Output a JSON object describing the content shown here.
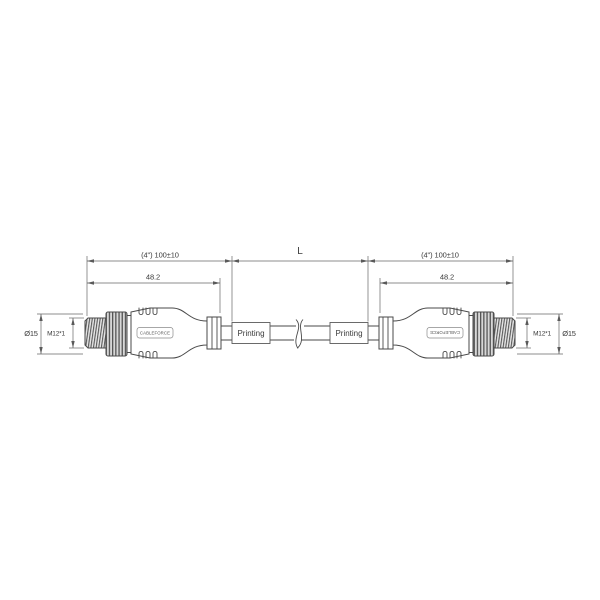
{
  "dimensions": {
    "overall_left": "(4\") 100±10",
    "overall_right": "(4\") 100±10",
    "length_label": "L",
    "body_left": "48.2",
    "body_right": "48.2",
    "thread_left": "M12*1",
    "thread_right": "M12*1",
    "diameter_left": "Ø15",
    "diameter_right": "Ø15"
  },
  "labels": {
    "printing_left": "Printing",
    "printing_right": "Printing",
    "brand_left": "CABLEFORCE",
    "brand_right": "CABLEFORCE"
  },
  "colors": {
    "outline": "#4a4a4a",
    "dimension_line": "#666666",
    "thread_dark": "#5a5a5a",
    "knurl_dark": "#555555",
    "background": "#ffffff"
  }
}
